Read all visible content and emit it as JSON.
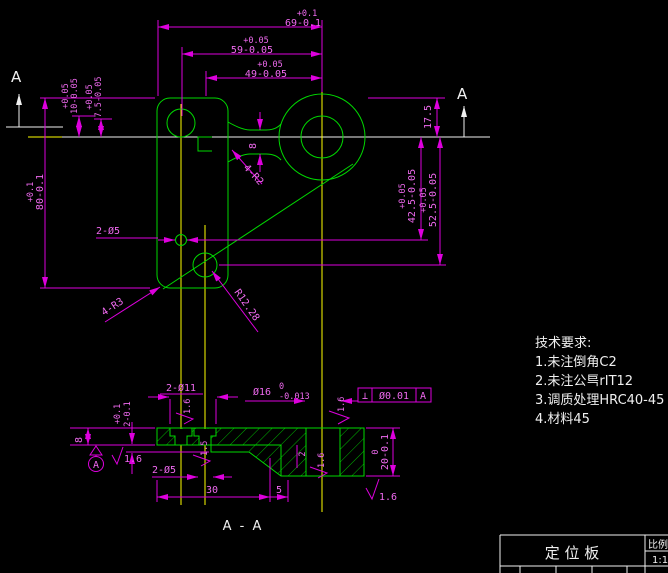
{
  "colors": {
    "background": "#000000",
    "outline_green": "#00d800",
    "dimension_magenta": "#dd00dd",
    "dim_text_pink": "#f06af0",
    "centerline_yellow": "#ffff00",
    "annotation_white": "#f0f0f0"
  },
  "main_view": {
    "section_marker_left": "A",
    "section_marker_right": "A",
    "dims": {
      "d69": {
        "tol": "+0.1",
        "val": "69-0.1"
      },
      "d59": {
        "tol": "+0.05",
        "val": "59-0.05"
      },
      "d49": {
        "tol": "+0.05",
        "val": "49-0.05"
      },
      "d10": {
        "tol": "+0.05",
        "val": "10-0.05"
      },
      "d7_5": {
        "tol": "+0.05",
        "val": "7.5-0.05"
      },
      "d80": {
        "tol": "+0.1",
        "val": "80-0.1"
      },
      "d17_5": "17.5",
      "d42_5": {
        "tol": "+0.05",
        "val": "42.5-0.05"
      },
      "d52_5": {
        "tol": "+0.05",
        "val": "52.5-0.05"
      },
      "neck_width": "8",
      "holes_2xd5": "2-Ø5",
      "fillet_4r2": "4-R2",
      "fillet_4r3": "4-R3",
      "fillet_r12": "R12.28"
    }
  },
  "section_view": {
    "label": "A - A",
    "dims": {
      "holes_2xd11": "2-Ø11",
      "bore_val": "Ø16",
      "bore_upper": "0",
      "bore_lower": "-0.013",
      "depth8": "8",
      "step2": {
        "tol": "+0.1",
        "val": "2-0.1"
      },
      "holes_2xd5": "2-Ø5",
      "d30": "30",
      "d5": "5",
      "chamfer2": "2",
      "thk_upper": "0",
      "thk_val": "20-0.1"
    },
    "fcf": {
      "symbol": "⊥",
      "tolerance": "Ø0.01",
      "datum": "A"
    },
    "datum_label": "A",
    "roughness": {
      "r_datum": "1.6",
      "r_top_left": "1.6",
      "r_hole": "1.5",
      "r_chamfer": "1.6",
      "r_top_right": "1.6",
      "r_bottom": "1.6"
    }
  },
  "tech_requirements": {
    "heading": "技术要求:",
    "item1": "1.未注倒角C2",
    "item2": "2.未注公巪rIT12",
    "item3": "3.调质处理HRC40-45",
    "item4": "4.材料45"
  },
  "title_block": {
    "part_name": "定 位 板",
    "scale_label": "比例",
    "scale_value": "1:1"
  }
}
